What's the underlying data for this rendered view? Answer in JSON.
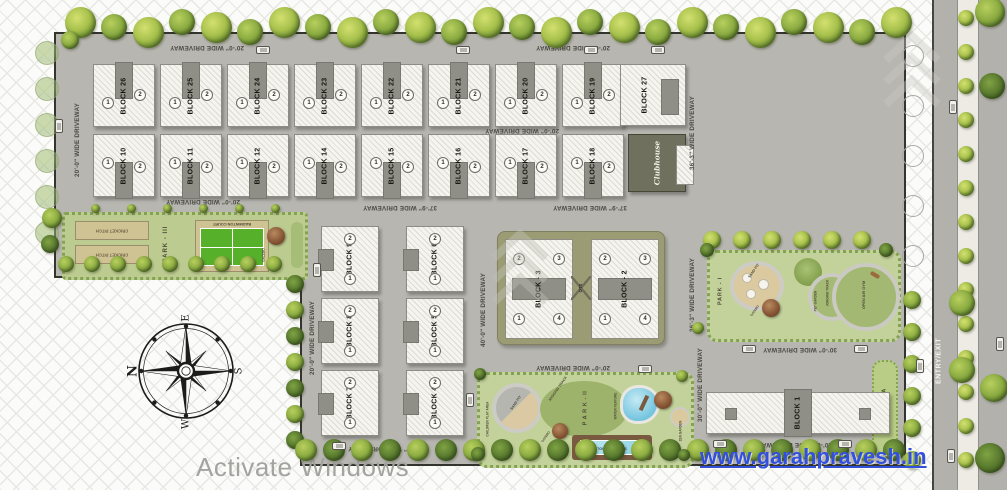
{
  "plan": {
    "driveways": [
      "20'-0\" WIDE DRIVEWAY",
      "20'-0\" WIDE DRIVEWAY",
      "20'-0\" WIDE DRIVEWAY",
      "20'-0\" WIDE DRIVEWAY",
      "37'-9\" WIDE DRIVEWAY",
      "37'-9\" WIDE DRIVEWAY",
      "20'-0\" WIDE DRIVEWAY",
      "20'-0\" WIDE DRIVEWAY",
      "40'-0\" WIDE DRIVEWAY",
      "36'-3\" WIDE DRIVEWAY",
      "36'-3\" WIDE DRIVEWAY",
      "35'-0\" WIDE DRIVEWAY",
      "30'-0\" WIDE DRIVEWAY",
      "30'-0\" WIDE DRIVEWAY",
      "20'-0\" WIDE DRIVEWAY",
      "20'-0\" WIDE DRIVEWAY"
    ],
    "entry_exit": "ENTRY/EXIT",
    "compass": {
      "n": "N",
      "e": "E",
      "s": "S",
      "w": "W"
    },
    "watermark": "www.garahpravesh.in",
    "os_overlay": "Activate Windows"
  },
  "blocks": {
    "row1": [
      {
        "label": "BLOCK 26",
        "u1": "1",
        "u2": "2"
      },
      {
        "label": "BLOCK 25",
        "u1": "1",
        "u2": "2"
      },
      {
        "label": "BLOCK 24",
        "u1": "1",
        "u2": "2"
      },
      {
        "label": "BLOCK 23",
        "u1": "1",
        "u2": "2"
      },
      {
        "label": "BLOCK 22",
        "u1": "1",
        "u2": "2"
      },
      {
        "label": "BLOCK 21",
        "u1": "1",
        "u2": "2"
      },
      {
        "label": "BLOCK 20",
        "u1": "1",
        "u2": "2"
      },
      {
        "label": "BLOCK 19",
        "u1": "1",
        "u2": "2"
      }
    ],
    "block27": {
      "label": "BLOCK 27"
    },
    "row2": [
      {
        "label": "BLOCK 10",
        "u1": "1",
        "u2": "2"
      },
      {
        "label": "BLOCK 11",
        "u1": "1",
        "u2": "2"
      },
      {
        "label": "BLOCK 12",
        "u1": "1",
        "u2": "2"
      },
      {
        "label": "BLOCK 14",
        "u1": "1",
        "u2": "2"
      },
      {
        "label": "BLOCK 15",
        "u1": "1",
        "u2": "2"
      },
      {
        "label": "BLOCK 16",
        "u1": "1",
        "u2": "2"
      },
      {
        "label": "BLOCK 17",
        "u1": "1",
        "u2": "2"
      },
      {
        "label": "BLOCK 18",
        "u1": "1",
        "u2": "2"
      }
    ],
    "clubhouse": {
      "label": "Clubhouse"
    },
    "mid_left": [
      {
        "label": "BLOCK 9",
        "u1": "1",
        "u2": "2"
      },
      {
        "label": "BLOCK 8",
        "u1": "1",
        "u2": "2"
      },
      {
        "label": "BLOCK 7",
        "u1": "1",
        "u2": "2"
      }
    ],
    "mid_right": [
      {
        "label": "BLOCK 6",
        "u1": "1",
        "u2": "2"
      },
      {
        "label": "BLOCK 5",
        "u1": "1",
        "u2": "2"
      },
      {
        "label": "BLOCK 4",
        "u1": "1",
        "u2": "2"
      }
    ],
    "center": [
      {
        "label": "BLOCK - 3",
        "units": [
          "2",
          "3",
          "1",
          "4"
        ]
      },
      {
        "label": "BLOCK - 2",
        "units": [
          "2",
          "3",
          "1",
          "4"
        ]
      }
    ],
    "ots": "OTS",
    "block1": {
      "label": "BLOCK 1"
    }
  },
  "parks": {
    "park3": {
      "name": "PARK - III",
      "cricket_pitch": "CRICKET PITCH",
      "badminton": "BADMINTON COURT",
      "gazebo": "GAZEBO"
    },
    "park1": {
      "name": "PARK - I",
      "sand_pit": "SAND PIT",
      "gazebo": "GAZEBO",
      "pet_garden": "PET GARDEN",
      "jogging_track": "JOGGING TRACK",
      "open_air_gym": "OPEN AIR GYM"
    },
    "park2": {
      "name": "P A R K - II",
      "children_play": "CHILDREN PLAY AREA",
      "sand_pit": "SAND PIT",
      "jogging_track": "JOGGING TRACK",
      "water_feature": "WATER FEATURE",
      "swimming_pool": "SWIMMING POOL",
      "zen_garden": "ZEN GARDEN",
      "gazebo": "GAZEBO"
    },
    "green_area": "GREEN AREA"
  },
  "colors": {
    "site_concrete": "#b7b6b0",
    "park_green": "#c3d29b",
    "tree_green": "#8bab41",
    "court_green": "#56b02a",
    "water_blue": "#74c4de",
    "clubhouse_olive": "#70705e",
    "link_blue": "#3350dd",
    "boundary": "#34342f"
  }
}
